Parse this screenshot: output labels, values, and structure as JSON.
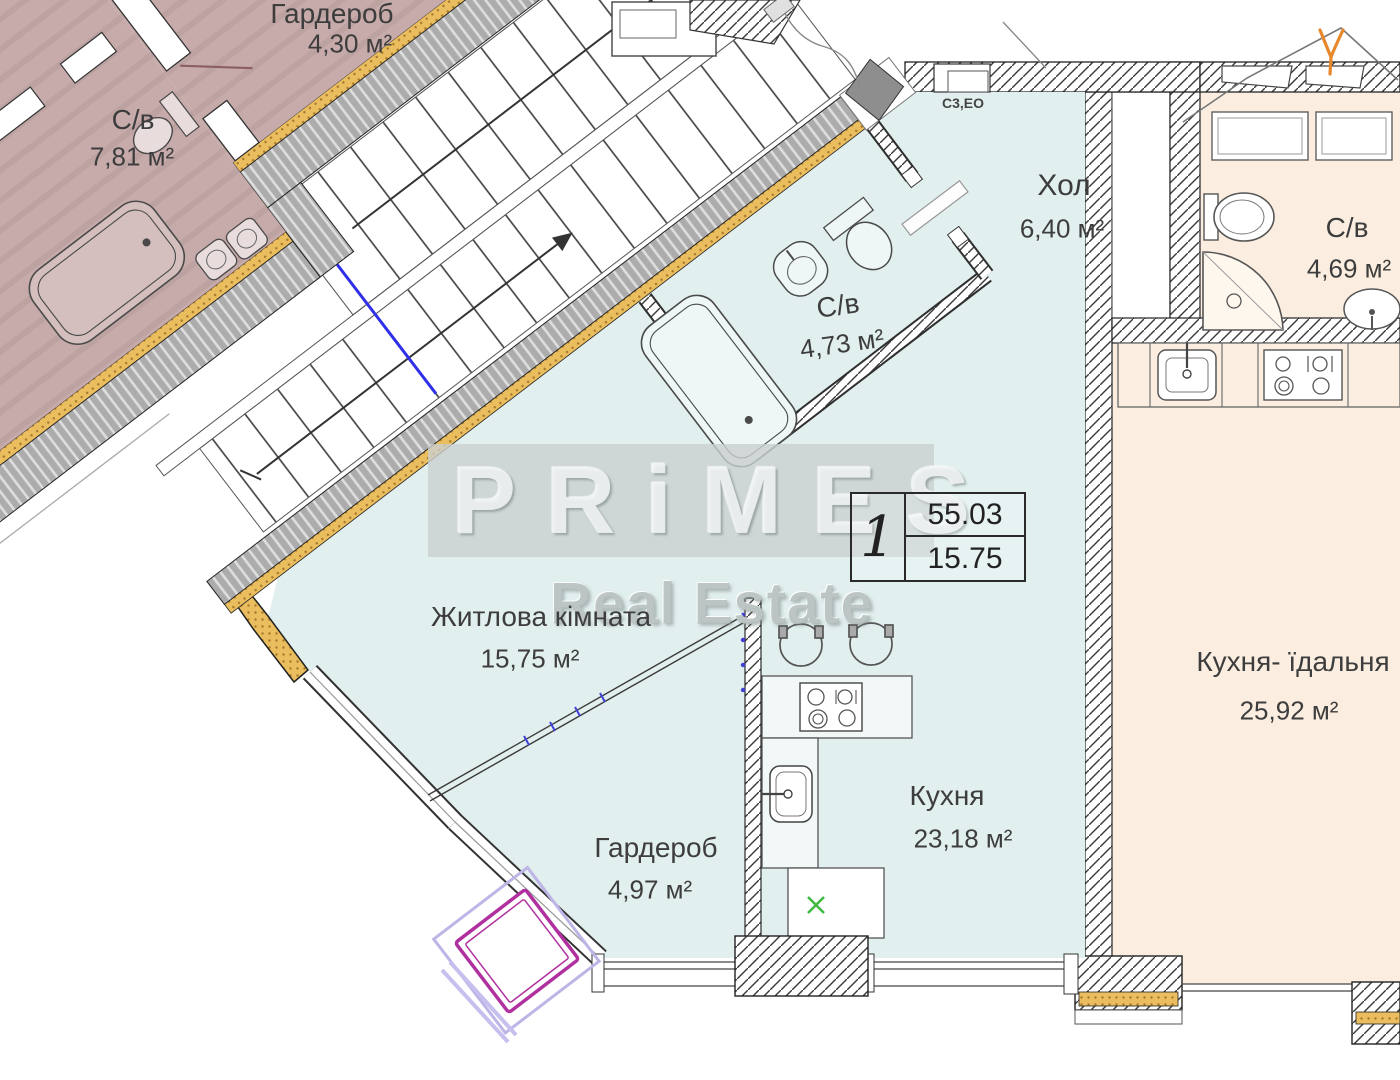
{
  "watermark": {
    "brand": "PRiMES",
    "tagline": "Real Estate"
  },
  "info_box": {
    "apartment_number": "1",
    "total_area": "55.03",
    "living_area": "15.75"
  },
  "annotations": {
    "electrical_label": "С3,ЕО"
  },
  "rooms": [
    {
      "id": "bathroom-781",
      "name": "С/в",
      "area": "7,81 м²"
    },
    {
      "id": "wardrobe-430",
      "name": "Гардероб",
      "area": "4,30 м²"
    },
    {
      "id": "hall",
      "name": "Хол",
      "area": "6,40 м²"
    },
    {
      "id": "bathroom-473",
      "name": "С/в",
      "area": "4,73 м²"
    },
    {
      "id": "bathroom-469",
      "name": "С/в",
      "area": "4,69 м²"
    },
    {
      "id": "living-room",
      "name": "Житлова кімната",
      "area": "15,75 м²"
    },
    {
      "id": "kitchen-dining",
      "name": "Кухня- їдальня",
      "area": "25,92 м²"
    },
    {
      "id": "kitchen",
      "name": "Кухня",
      "area": "23,18 м²"
    },
    {
      "id": "wardrobe-497",
      "name": "Гардероб",
      "area": "4,97 м²"
    }
  ],
  "colors": {
    "apartment_fill": "#e2efef",
    "neighbor_fill_left": "#c7abab",
    "neighbor_fill_right": "#fbeee0",
    "insulation": "#eabd5e",
    "stair_wall": "#acacac",
    "marker_blue": "#2f2fe8",
    "marker_green": "#42b842",
    "marker_magenta": "#b0309f",
    "marker_orange": "#e8872b"
  }
}
